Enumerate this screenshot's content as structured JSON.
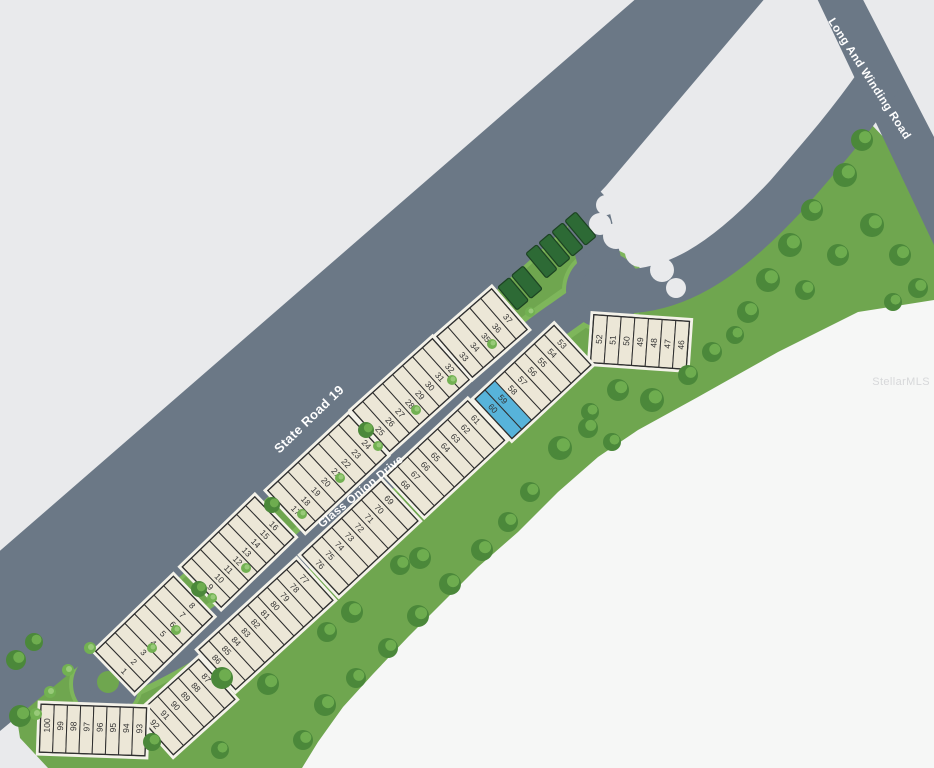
{
  "map": {
    "watermark": "StellarMLS",
    "colors": {
      "background": "#e9eaec",
      "cleared": "#f6f7f6",
      "road": "#6b7886",
      "grass": "#6fa64f",
      "verge": "#7eb65b",
      "lot_fill": "#ece7d7",
      "lot_stroke": "#2f2f2f",
      "lot_halo": "#f4f2e9",
      "selected_fill": "#57b3da",
      "reserved_fill": "#2d6a35",
      "reserved_stroke": "#1c4322",
      "tree_dark": "#4b883a",
      "tree_light": "#72b152",
      "label_color": "#ffffff",
      "number_color": "#333333"
    },
    "roads": [
      {
        "id": "state-road-19",
        "label": "State Road 19",
        "label_x": 309,
        "label_y": 419,
        "label_angle": -44,
        "font_size": 13
      },
      {
        "id": "long-and-winding-road",
        "label": "Long And Winding Road",
        "label_x": 869,
        "label_y": 79,
        "label_angle": 57,
        "font_size": 11.5
      },
      {
        "id": "glass-onion-drive",
        "label": "Glass Onion Drive",
        "label_x": 361,
        "label_y": 492,
        "label_angle": -39.5,
        "font_size": 11.5
      }
    ],
    "selected_lots": [
      "59",
      "60"
    ],
    "strips": [
      {
        "id": "lots-1-8",
        "cx": 154,
        "cy": 634,
        "angle": -44,
        "pitch": 13.5,
        "len": 56,
        "num_rot": 90,
        "num_off": 6,
        "numbers": [
          "1",
          "2",
          "3",
          "4",
          "5",
          "6",
          "7",
          "8"
        ]
      },
      {
        "id": "lots-9-16",
        "cx": 238,
        "cy": 552,
        "angle": -44,
        "pitch": 12.6,
        "len": 56,
        "num_rot": 90,
        "num_off": 6,
        "numbers": [
          "9",
          "10",
          "11",
          "12",
          "13",
          "14",
          "15",
          "16"
        ]
      },
      {
        "id": "lots-17-24",
        "cx": 327,
        "cy": 473,
        "angle": -43,
        "pitch": 13.8,
        "len": 55,
        "num_rot": 90,
        "num_off": 6,
        "numbers": [
          "17",
          "18",
          "19",
          "20",
          "21",
          "22",
          "23",
          "24"
        ]
      },
      {
        "id": "lots-25-32",
        "cx": 411,
        "cy": 395,
        "angle": -42,
        "pitch": 13.4,
        "len": 55,
        "num_rot": 90,
        "num_off": 6,
        "numbers": [
          "25",
          "26",
          "27",
          "28",
          "29",
          "30",
          "31",
          "32"
        ]
      },
      {
        "id": "lots-33-37",
        "cx": 482,
        "cy": 333,
        "angle": -41,
        "pitch": 14.5,
        "len": 54,
        "num_rot": 90,
        "num_off": 6,
        "numbers": [
          "33",
          "34",
          "35",
          "36",
          "37"
        ]
      },
      {
        "id": "lots-46-52",
        "cx": 640,
        "cy": 342,
        "angle": 4,
        "pitch": 13.7,
        "len": 48,
        "num_rot": -90,
        "num_off": 0,
        "numbers": [
          "52",
          "51",
          "50",
          "49",
          "48",
          "47",
          "46"
        ]
      },
      {
        "id": "lots-53-60",
        "cx": 533,
        "cy": 382,
        "angle": -43,
        "pitch": 13.5,
        "len": 54,
        "num_rot": 90,
        "num_off": -8,
        "numbers": [
          "60",
          "59",
          "58",
          "57",
          "56",
          "55",
          "54",
          "53"
        ]
      },
      {
        "id": "lots-61-68",
        "cx": 446,
        "cy": 458,
        "angle": -43,
        "pitch": 13.7,
        "len": 54,
        "num_rot": 90,
        "num_off": -8,
        "numbers": [
          "68",
          "67",
          "66",
          "65",
          "64",
          "63",
          "62",
          "61"
        ]
      },
      {
        "id": "lots-69-76",
        "cx": 360,
        "cy": 538,
        "angle": -43,
        "pitch": 13.5,
        "len": 54,
        "num_rot": 90,
        "num_off": -8,
        "numbers": [
          "76",
          "75",
          "74",
          "73",
          "72",
          "71",
          "70",
          "69"
        ]
      },
      {
        "id": "lots-77-86",
        "cx": 266,
        "cy": 625,
        "angle": -42.5,
        "pitch": 13.2,
        "len": 54,
        "num_rot": 90,
        "num_off": -8,
        "numbers": [
          "86",
          "85",
          "84",
          "83",
          "82",
          "81",
          "80",
          "79",
          "78",
          "77"
        ]
      },
      {
        "id": "lots-87-92",
        "cx": 186,
        "cy": 707,
        "angle": -42,
        "pitch": 13.8,
        "len": 54,
        "num_rot": 90,
        "num_off": -8,
        "numbers": [
          "92",
          "91",
          "90",
          "89",
          "88",
          "87"
        ]
      },
      {
        "id": "lots-93-100",
        "cx": 93,
        "cy": 730,
        "angle": 2,
        "pitch": 13.2,
        "len": 48,
        "num_rot": -90,
        "num_off": -3,
        "numbers": [
          "100",
          "99",
          "98",
          "97",
          "96",
          "95",
          "94",
          "93"
        ]
      }
    ],
    "reserved_strips": [
      {
        "id": "reserved-parcels-a",
        "cx": 520,
        "cy": 288,
        "angle": -40,
        "pitch": 18,
        "len": 30,
        "count": 2
      },
      {
        "id": "reserved-parcels-b",
        "cx": 561,
        "cy": 245,
        "angle": -40,
        "pitch": 17,
        "len": 32,
        "count": 4
      }
    ],
    "decor": {
      "trees": [
        [
          862,
          140,
          11
        ],
        [
          845,
          175,
          12
        ],
        [
          812,
          210,
          11
        ],
        [
          790,
          245,
          12
        ],
        [
          768,
          280,
          12
        ],
        [
          748,
          312,
          11
        ],
        [
          805,
          290,
          10
        ],
        [
          838,
          255,
          11
        ],
        [
          872,
          225,
          12
        ],
        [
          900,
          255,
          11
        ],
        [
          918,
          288,
          10
        ],
        [
          893,
          302,
          9
        ],
        [
          735,
          335,
          9
        ],
        [
          618,
          390,
          11
        ],
        [
          652,
          400,
          12
        ],
        [
          688,
          375,
          10
        ],
        [
          712,
          352,
          10
        ],
        [
          590,
          412,
          9
        ],
        [
          560,
          448,
          12
        ],
        [
          588,
          428,
          10
        ],
        [
          612,
          442,
          9
        ],
        [
          530,
          492,
          10
        ],
        [
          508,
          522,
          10
        ],
        [
          482,
          550,
          11
        ],
        [
          450,
          584,
          11
        ],
        [
          418,
          616,
          11
        ],
        [
          388,
          648,
          10
        ],
        [
          352,
          612,
          11
        ],
        [
          327,
          632,
          10
        ],
        [
          420,
          558,
          11
        ],
        [
          400,
          565,
          10
        ],
        [
          356,
          678,
          10
        ],
        [
          325,
          705,
          11
        ],
        [
          303,
          740,
          10
        ],
        [
          366,
          430,
          8
        ],
        [
          272,
          505,
          8
        ],
        [
          199,
          589,
          8
        ],
        [
          222,
          678,
          11
        ],
        [
          268,
          684,
          11
        ],
        [
          152,
          742,
          9
        ],
        [
          220,
          750,
          9
        ],
        [
          20,
          716,
          11
        ],
        [
          16,
          660,
          10
        ],
        [
          34,
          642,
          9
        ]
      ],
      "bushes": [
        [
          152,
          648,
          5
        ],
        [
          176,
          630,
          5
        ],
        [
          212,
          598,
          5
        ],
        [
          246,
          568,
          5
        ],
        [
          302,
          514,
          5
        ],
        [
          340,
          478,
          5
        ],
        [
          378,
          446,
          5
        ],
        [
          416,
          410,
          5
        ],
        [
          452,
          380,
          5
        ],
        [
          492,
          344,
          5
        ],
        [
          530,
          312,
          5
        ],
        [
          50,
          692,
          6
        ],
        [
          68,
          670,
          6
        ],
        [
          90,
          648,
          6
        ],
        [
          36,
          714,
          6
        ]
      ]
    }
  }
}
